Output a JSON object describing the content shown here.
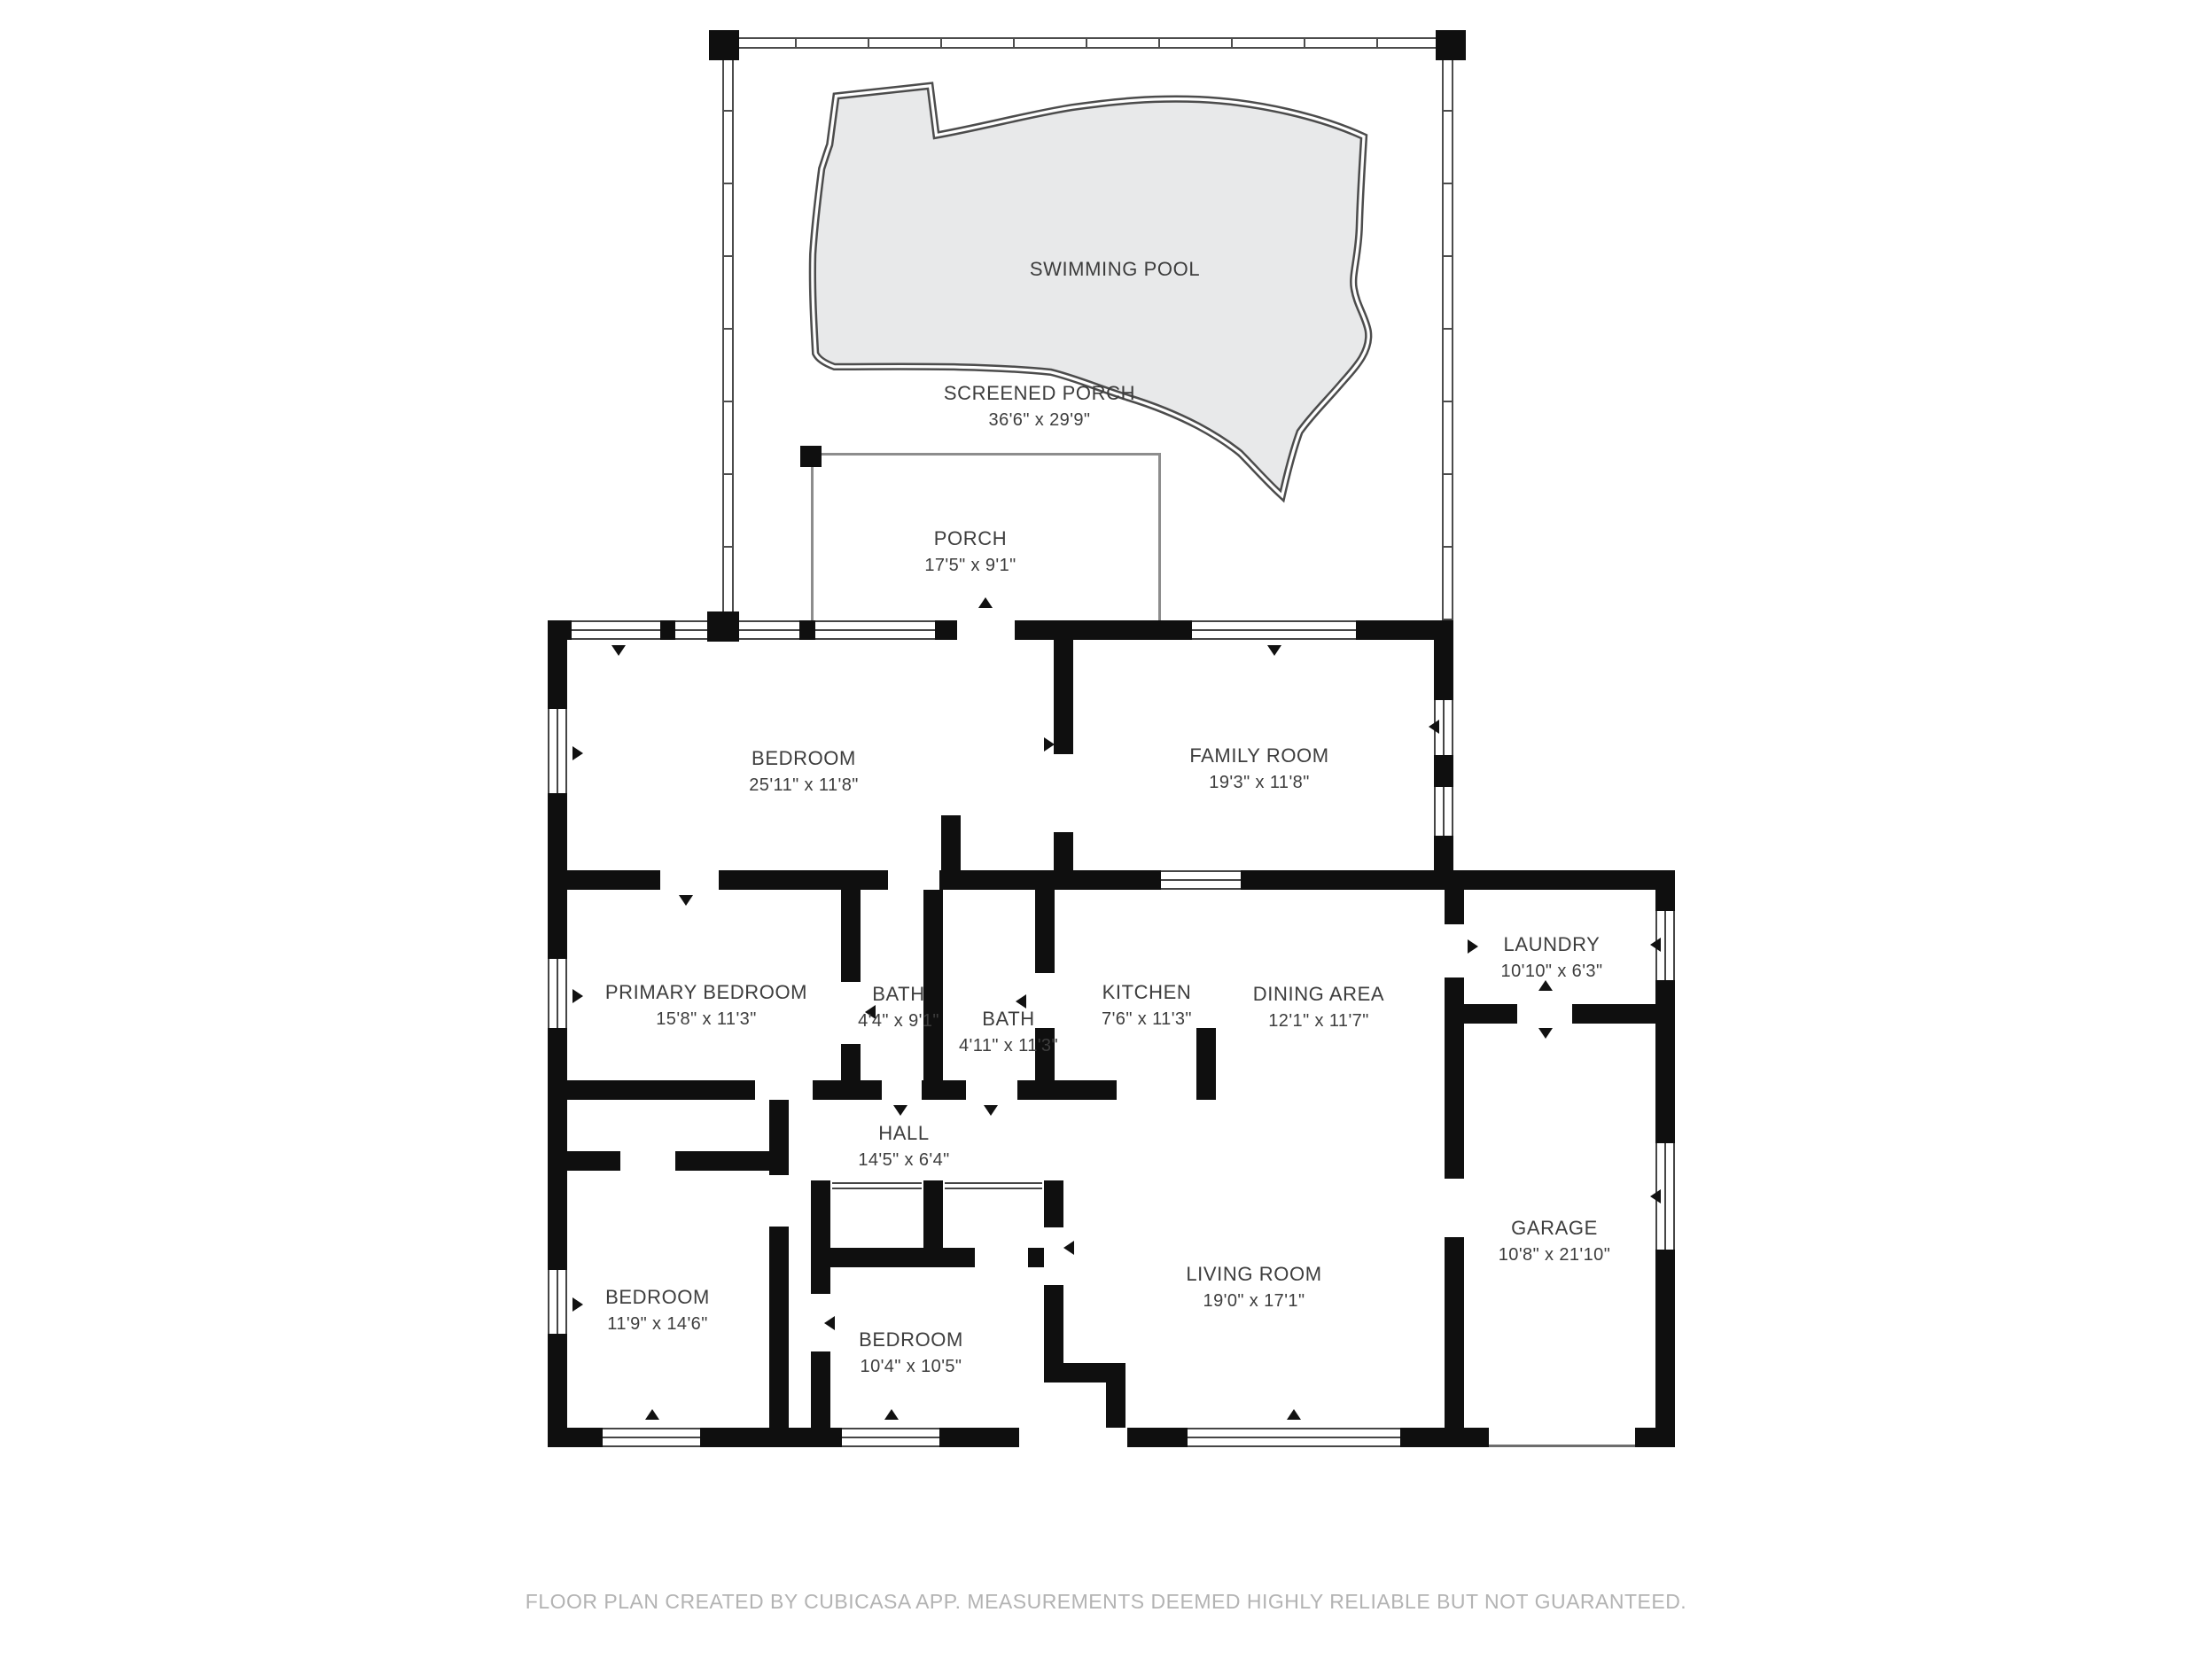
{
  "rooms": [
    {
      "id": "swimming-pool",
      "name": "SWIMMING POOL",
      "dims": ""
    },
    {
      "id": "screened-porch",
      "name": "SCREENED PORCH",
      "dims": "36'6\" x 29'9\""
    },
    {
      "id": "porch",
      "name": "PORCH",
      "dims": "17'5\" x 9'1\""
    },
    {
      "id": "bedroom-top",
      "name": "BEDROOM",
      "dims": "25'11\" x 11'8\""
    },
    {
      "id": "family-room",
      "name": "FAMILY ROOM",
      "dims": "19'3\" x 11'8\""
    },
    {
      "id": "primary-bedroom",
      "name": "PRIMARY BEDROOM",
      "dims": "15'8\" x 11'3\""
    },
    {
      "id": "bath-small",
      "name": "BATH",
      "dims": "4'4\" x 9'1\""
    },
    {
      "id": "bath-large",
      "name": "BATH",
      "dims": "4'11\" x 11'3\""
    },
    {
      "id": "kitchen",
      "name": "KITCHEN",
      "dims": "7'6\" x 11'3\""
    },
    {
      "id": "dining-area",
      "name": "DINING AREA",
      "dims": "12'1\" x 11'7\""
    },
    {
      "id": "laundry",
      "name": "LAUNDRY",
      "dims": "10'10\" x 6'3\""
    },
    {
      "id": "garage",
      "name": "GARAGE",
      "dims": "10'8\" x 21'10\""
    },
    {
      "id": "hall",
      "name": "HALL",
      "dims": "14'5\" x 6'4\""
    },
    {
      "id": "bedroom-left",
      "name": "BEDROOM",
      "dims": "11'9\" x 14'6\""
    },
    {
      "id": "bedroom-middle",
      "name": "BEDROOM",
      "dims": "10'4\" x 10'5\""
    },
    {
      "id": "living-room",
      "name": "LIVING ROOM",
      "dims": "19'0\" x 17'1\""
    }
  ],
  "footer": {
    "text": "FLOOR PLAN CREATED BY CUBICASA APP. MEASUREMENTS DEEMED HIGHLY RELIABLE BUT NOT GUARANTEED."
  },
  "colors": {
    "wall": "#0f0f0f",
    "pool_fill": "#e8e9ea",
    "outline": "#4c4c4c",
    "porch_line": "#8d8d8d",
    "label_text": "#3d3d3d",
    "footer_text": "#b3b3b3",
    "background": "#ffffff"
  }
}
